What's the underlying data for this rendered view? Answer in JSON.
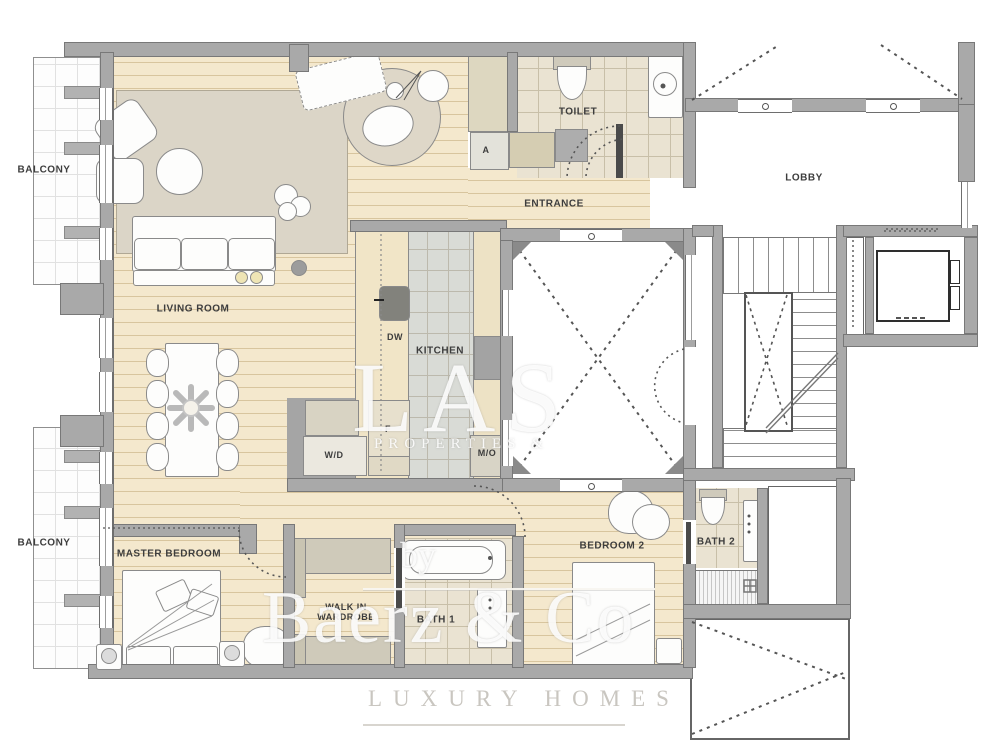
{
  "labels": {
    "balcony": "BALCONY",
    "living": "LIVING ROOM",
    "kitchen": "KITCHEN",
    "dw": "DW",
    "fridge": "F",
    "wd": "W/D",
    "mo": "M/O",
    "a": "A",
    "toilet": "TOILET",
    "entrance": "ENTRANCE",
    "lobby": "LOBBY",
    "master": "MASTER BEDROOM",
    "walkin": "WALK IN\nWARDROBE",
    "bath1": "BATH 1",
    "bedroom2": "BEDROOM 2",
    "bath2": "BATH 2"
  },
  "watermark": {
    "big": "LAS",
    "sub": "PROPERTIES &",
    "by": "by",
    "brand": "Baerz & Co",
    "tagline": "LUXURY HOMES"
  },
  "colors": {
    "wall": "#a9a9a9",
    "wood_floor": "#f4e8cd",
    "wood_stripe": "#d8c59e",
    "kitchen_tile": "#d9dbd6",
    "bath_tile": "#eae3d2",
    "rug": "#dbd5c7",
    "label_text": "#3d3d3d"
  }
}
